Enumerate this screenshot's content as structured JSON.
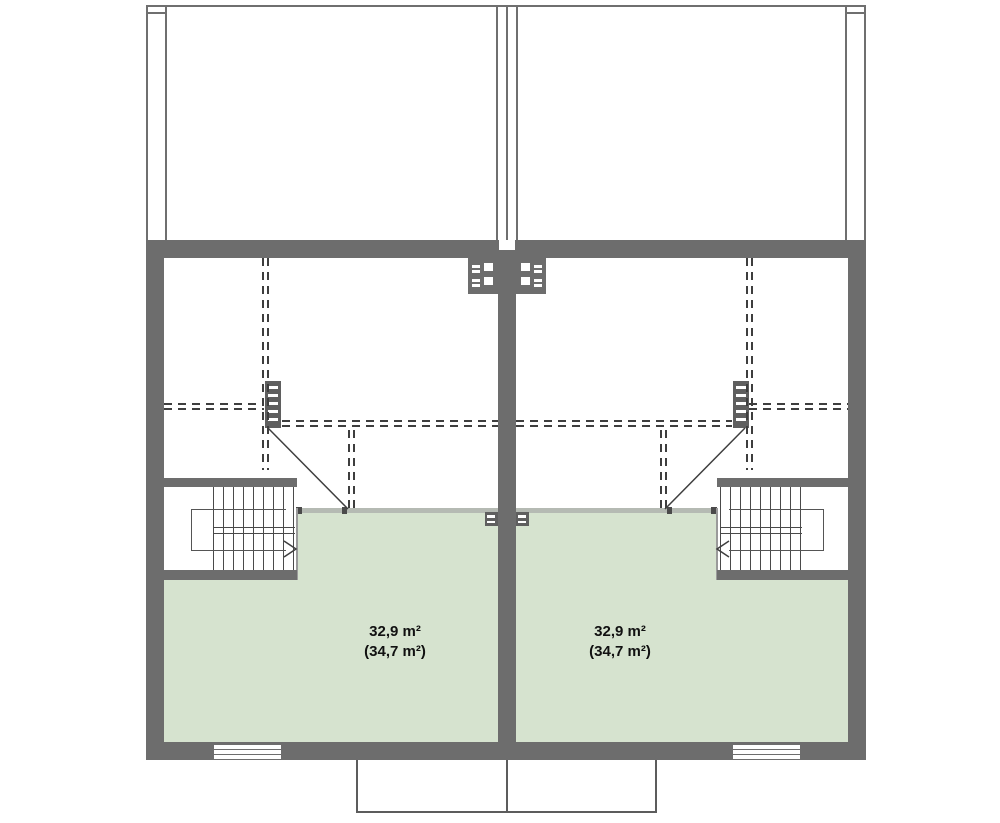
{
  "plan": {
    "type": "attic-floor-plan-duplex",
    "units": [
      {
        "id": "left",
        "room": {
          "area_label": "32,9 m²",
          "area_label_secondary": "(34,7 m²)"
        }
      },
      {
        "id": "right",
        "room": {
          "area_label": "32,9 m²",
          "area_label_secondary": "(34,7 m²)"
        }
      }
    ],
    "colors": {
      "wall": "#6d6d6d",
      "room_fill": "#d6e3cf",
      "dash_line": "#3e3e3e",
      "thin_outline": "#6f6f6f",
      "knee_wall": "#b5bab3",
      "stair_line": "#4a4a4a"
    }
  }
}
